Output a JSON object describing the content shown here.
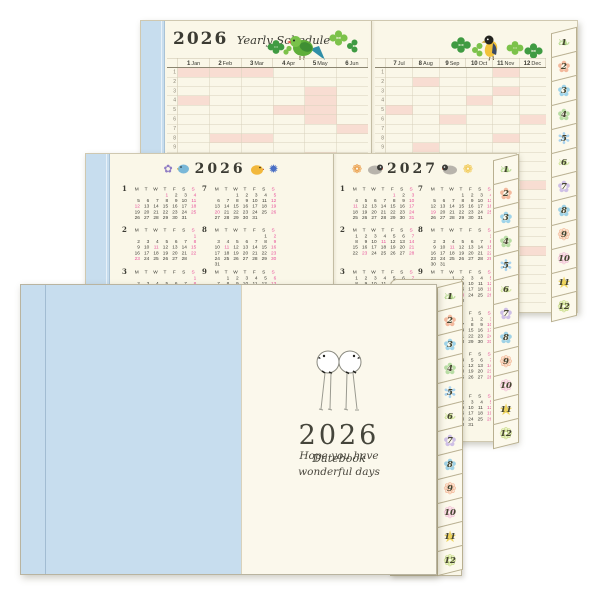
{
  "colors": {
    "paper": "#faf7e8",
    "cover_blue": "#c7ddee",
    "highlight_pink": "#f8ddd2",
    "sunday_pink": "#e8509a",
    "clover_green_dark": "#3f9b42",
    "clover_green_light": "#7cc24a"
  },
  "weekday_header": [
    "M",
    "T",
    "W",
    "T",
    "F",
    "S",
    "S"
  ],
  "yearly_schedule": {
    "year": "2026",
    "script_title": "Yearly Schedule",
    "rows": 31,
    "left_column_labels": [
      "1 Jan",
      "2 Feb",
      "3 Mar",
      "4 Apr",
      "5 May",
      "6 Jun"
    ],
    "right_column_labels": [
      "7 Jul",
      "8 Aug",
      "9 Sep",
      "10 Oct",
      "11 Nov",
      "12 Dec"
    ]
  },
  "calendar_pages": {
    "left": {
      "year": "2026",
      "months": [
        {
          "num": "1",
          "first_dow": 3,
          "days": 31,
          "holidays": [
            1,
            12
          ]
        },
        {
          "num": "2",
          "first_dow": 6,
          "days": 28,
          "holidays": [
            11,
            23
          ]
        },
        {
          "num": "3",
          "first_dow": 6,
          "days": 31,
          "holidays": [
            20
          ]
        },
        {
          "num": "4",
          "first_dow": 2,
          "days": 30,
          "holidays": [
            29
          ]
        },
        {
          "num": "5",
          "first_dow": 4,
          "days": 31,
          "holidays": [
            3,
            4,
            5,
            6
          ]
        },
        {
          "num": "6",
          "first_dow": 0,
          "days": 30,
          "holidays": []
        },
        {
          "num": "7",
          "first_dow": 2,
          "days": 31,
          "holidays": [
            20
          ]
        },
        {
          "num": "8",
          "first_dow": 5,
          "days": 31,
          "holidays": [
            11
          ]
        },
        {
          "num": "9",
          "first_dow": 1,
          "days": 30,
          "holidays": [
            21,
            22,
            23
          ]
        },
        {
          "num": "10",
          "first_dow": 3,
          "days": 31,
          "holidays": [
            12
          ]
        },
        {
          "num": "11",
          "first_dow": 6,
          "days": 30,
          "holidays": [
            3,
            23
          ]
        },
        {
          "num": "12",
          "first_dow": 1,
          "days": 31,
          "holidays": []
        }
      ]
    },
    "right": {
      "year": "2027",
      "months": [
        {
          "num": "1",
          "first_dow": 4,
          "days": 31,
          "holidays": [
            1,
            11
          ]
        },
        {
          "num": "2",
          "first_dow": 0,
          "days": 28,
          "holidays": [
            11,
            23
          ]
        },
        {
          "num": "3",
          "first_dow": 0,
          "days": 31,
          "holidays": [
            21,
            22
          ]
        },
        {
          "num": "4",
          "first_dow": 3,
          "days": 30,
          "holidays": [
            29
          ]
        },
        {
          "num": "5",
          "first_dow": 5,
          "days": 31,
          "holidays": [
            3,
            4,
            5
          ]
        },
        {
          "num": "6",
          "first_dow": 1,
          "days": 30,
          "holidays": []
        },
        {
          "num": "7",
          "first_dow": 3,
          "days": 31,
          "holidays": [
            19
          ]
        },
        {
          "num": "8",
          "first_dow": 6,
          "days": 31,
          "holidays": [
            11
          ]
        },
        {
          "num": "9",
          "first_dow": 2,
          "days": 30,
          "holidays": [
            20,
            23
          ]
        },
        {
          "num": "10",
          "first_dow": 4,
          "days": 31,
          "holidays": [
            11
          ]
        },
        {
          "num": "11",
          "first_dow": 0,
          "days": 30,
          "holidays": [
            3,
            23
          ]
        },
        {
          "num": "12",
          "first_dow": 2,
          "days": 31,
          "holidays": []
        }
      ]
    }
  },
  "tabs": [
    {
      "label": "1",
      "glyph": "❧",
      "color": "#b5d98f"
    },
    {
      "label": "2",
      "glyph": "✿",
      "color": "#f3b99d"
    },
    {
      "label": "3",
      "glyph": "✿",
      "color": "#9fd4ea"
    },
    {
      "label": "4",
      "glyph": "✿",
      "color": "#b8dda4"
    },
    {
      "label": "5",
      "glyph": "✻",
      "color": "#a9d3ef"
    },
    {
      "label": "6",
      "glyph": "❧",
      "color": "#cfe49a"
    },
    {
      "label": "7",
      "glyph": "✿",
      "color": "#cfc0e6"
    },
    {
      "label": "8",
      "glyph": "✿",
      "color": "#9fd2e6"
    },
    {
      "label": "9",
      "glyph": "❁",
      "color": "#f3b493"
    },
    {
      "label": "10",
      "glyph": "❁",
      "color": "#f1bcd6"
    },
    {
      "label": "11",
      "glyph": "★",
      "color": "#eed45e"
    },
    {
      "label": "12",
      "glyph": "❁",
      "color": "#c6dc82"
    }
  ],
  "cover": {
    "year": "2026",
    "title_script": "Datebook",
    "tagline": [
      "Hope you have",
      "wonderful days"
    ]
  }
}
